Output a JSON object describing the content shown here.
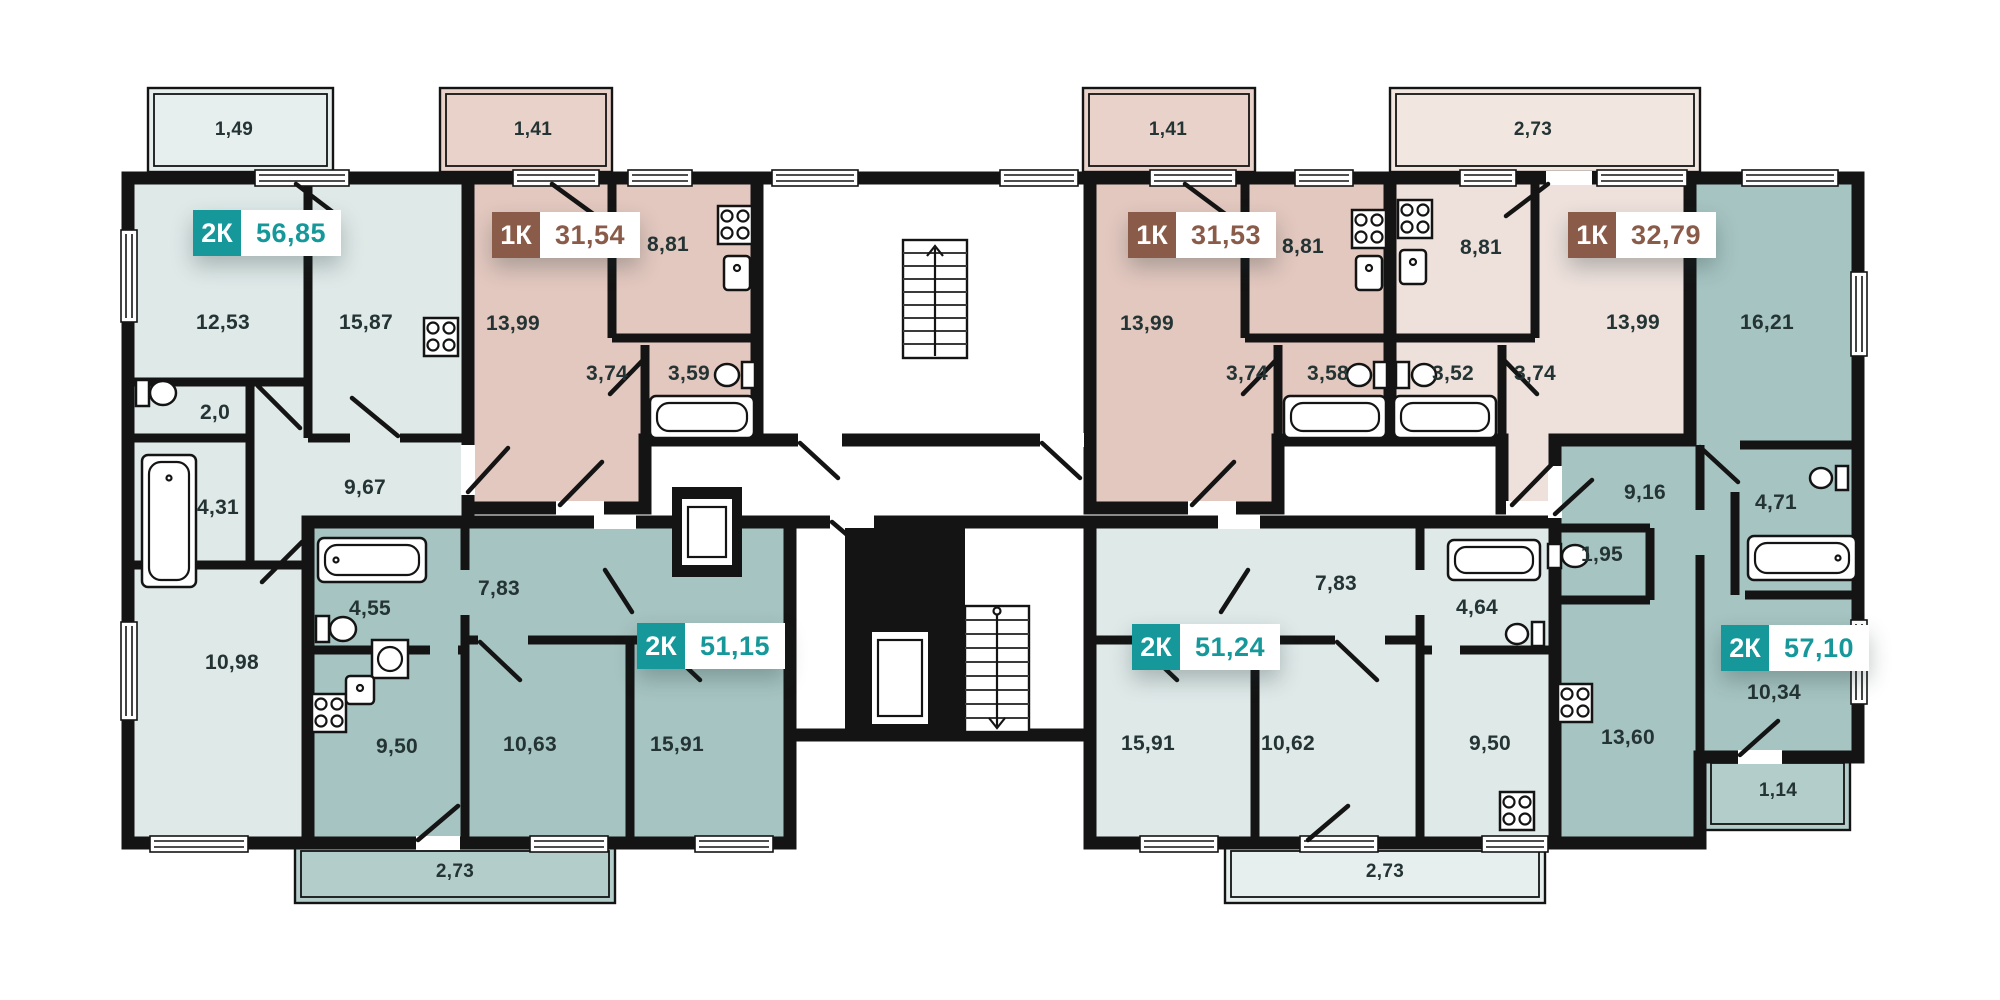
{
  "plan": {
    "colors": {
      "apartment_light": "#dfe9e8",
      "apartment_rose": "#e3c8bf",
      "apartment_rose_light": "#eee1dc",
      "apartment_teal": "#a6c4c2",
      "balcony_light": "#e6efee",
      "balcony_rose": "#e9d2ca",
      "balcony_rose_light": "#f2e6e1",
      "balcony_teal": "#b3cdcb",
      "badge_1k": "#8a5b49",
      "badge_2k": "#16989b",
      "wall": "#141414",
      "label": "#243434"
    },
    "apartments": [
      {
        "type": "2К",
        "area": "56,85",
        "badge": {
          "x": 193,
          "y": 210
        },
        "rooms": [
          {
            "area": "12,53",
            "x": 223,
            "y": 323
          },
          {
            "area": "15,87",
            "x": 366,
            "y": 323
          },
          {
            "area": "2,0",
            "x": 215,
            "y": 413
          },
          {
            "area": "4,31",
            "x": 218,
            "y": 508
          },
          {
            "area": "9,67",
            "x": 365,
            "y": 488
          },
          {
            "area": "10,98",
            "x": 232,
            "y": 663
          }
        ]
      },
      {
        "type": "1К",
        "area": "31,54",
        "badge": {
          "x": 492,
          "y": 212
        },
        "rooms": [
          {
            "area": "13,99",
            "x": 513,
            "y": 324
          },
          {
            "area": "8,81",
            "x": 668,
            "y": 245
          },
          {
            "area": "3,74",
            "x": 607,
            "y": 374
          },
          {
            "area": "3,59",
            "x": 689,
            "y": 374
          }
        ]
      },
      {
        "type": "1К",
        "area": "31,53",
        "badge": {
          "x": 1128,
          "y": 212
        },
        "rooms": [
          {
            "area": "13,99",
            "x": 1147,
            "y": 324
          },
          {
            "area": "8,81",
            "x": 1303,
            "y": 247
          },
          {
            "area": "3,74",
            "x": 1247,
            "y": 374
          },
          {
            "area": "3,58",
            "x": 1328,
            "y": 374
          }
        ]
      },
      {
        "type": "1К",
        "area": "32,79",
        "badge": {
          "x": 1568,
          "y": 212
        },
        "rooms": [
          {
            "area": "8,81",
            "x": 1481,
            "y": 248
          },
          {
            "area": "13,99",
            "x": 1633,
            "y": 323
          },
          {
            "area": "3,52",
            "x": 1453,
            "y": 374
          },
          {
            "area": "3,74",
            "x": 1535,
            "y": 374
          }
        ]
      },
      {
        "type": "2К",
        "area": "51,15",
        "badge": {
          "x": 637,
          "y": 623
        },
        "rooms": [
          {
            "area": "7,83",
            "x": 499,
            "y": 589
          },
          {
            "area": "4,55",
            "x": 370,
            "y": 609
          },
          {
            "area": "9,50",
            "x": 397,
            "y": 747
          },
          {
            "area": "10,63",
            "x": 530,
            "y": 745
          },
          {
            "area": "15,91",
            "x": 677,
            "y": 745
          }
        ]
      },
      {
        "type": "2К",
        "area": "51,24",
        "badge": {
          "x": 1132,
          "y": 624
        },
        "rooms": [
          {
            "area": "7,83",
            "x": 1336,
            "y": 584
          },
          {
            "area": "4,64",
            "x": 1477,
            "y": 608
          },
          {
            "area": "15,91",
            "x": 1148,
            "y": 744
          },
          {
            "area": "10,62",
            "x": 1288,
            "y": 744
          },
          {
            "area": "9,50",
            "x": 1490,
            "y": 744
          }
        ]
      },
      {
        "type": "2К",
        "area": "57,10",
        "badge": {
          "x": 1721,
          "y": 625
        },
        "rooms": [
          {
            "area": "16,21",
            "x": 1767,
            "y": 323
          },
          {
            "area": "9,16",
            "x": 1645,
            "y": 493
          },
          {
            "area": "4,71",
            "x": 1776,
            "y": 503
          },
          {
            "area": "1,95",
            "x": 1602,
            "y": 555
          },
          {
            "area": "13,60",
            "x": 1628,
            "y": 738
          },
          {
            "area": "10,34",
            "x": 1774,
            "y": 693
          }
        ]
      }
    ],
    "balconies": [
      {
        "area": "1,49",
        "x": 234,
        "y": 130
      },
      {
        "area": "1,41",
        "x": 533,
        "y": 130
      },
      {
        "area": "1,41",
        "x": 1168,
        "y": 130
      },
      {
        "area": "2,73",
        "x": 1533,
        "y": 130
      },
      {
        "area": "2,73",
        "x": 455,
        "y": 872
      },
      {
        "area": "2,73",
        "x": 1385,
        "y": 872
      },
      {
        "area": "1,14",
        "x": 1778,
        "y": 791
      }
    ]
  }
}
